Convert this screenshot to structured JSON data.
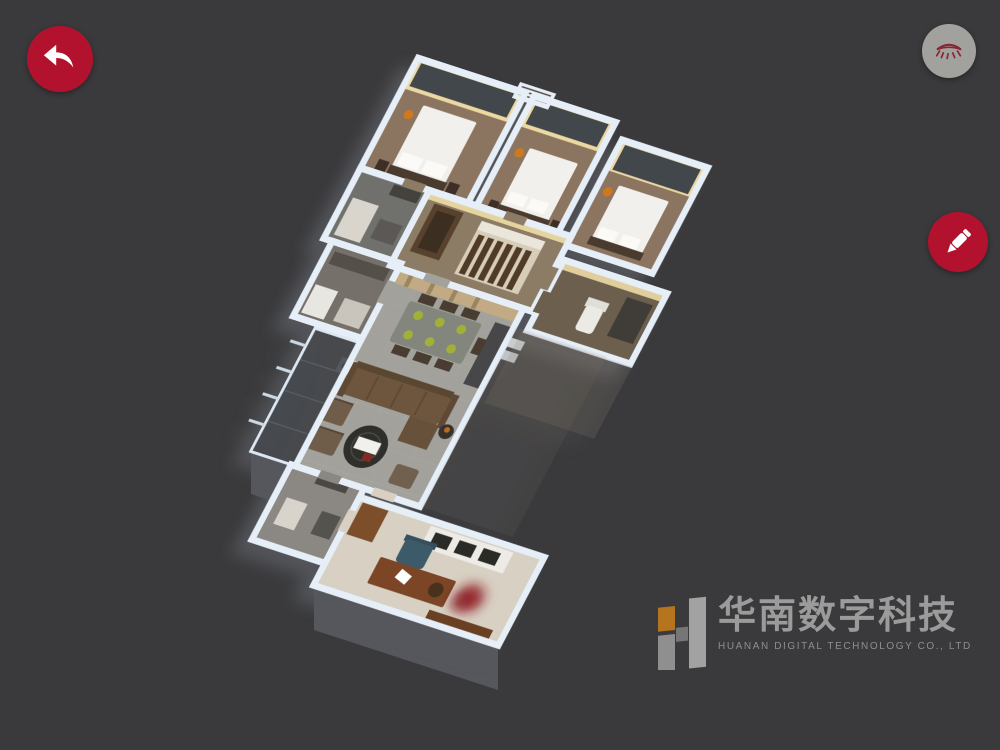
{
  "canvas": {
    "background": "#3a3a3c",
    "width": 1000,
    "height": 750
  },
  "toolbar": {
    "back_button": {
      "icon": "back-arrow-icon",
      "bg_color": "#b2122d",
      "fg_color": "#ffffff"
    },
    "visibility_button": {
      "icon": "closed-eye-icon",
      "bg_color": "#a1a19d",
      "fg_color": "#8b2433"
    },
    "pen_button": {
      "icon": "pen-icon",
      "bg_color": "#b2122d",
      "fg_color": "#ffffff"
    }
  },
  "logo": {
    "mark": "H",
    "mark_orange": "#b5741e",
    "mark_gray": "#949494",
    "title_zh": "华南数字科技",
    "subtitle_en": "HUANAN DIGITAL TECHNOLOGY CO., LTD",
    "text_color": "#9b9b9b",
    "subtitle_color": "#8e8e8e"
  },
  "scene": {
    "type": "3d-dollhouse-floorplan",
    "wall_color": "#e6eef8",
    "accent_lamp_color": "#d0781c",
    "plate_color": "#a2b038",
    "red_plant_color": "#8e141e",
    "rooms": [
      {
        "name": "bedroom-1",
        "furniture": [
          "double-bed",
          "dark-curtains",
          "bedside-lamp",
          "nightstands",
          "headboard"
        ]
      },
      {
        "name": "bedroom-2",
        "furniture": [
          "double-bed",
          "dark-curtains",
          "bedside-lamp",
          "nightstands"
        ]
      },
      {
        "name": "bedroom-3",
        "furniture": [
          "double-bed",
          "dark-curtains",
          "bedside-lamp",
          "nightstands"
        ]
      },
      {
        "name": "bathroom-1",
        "furniture": [
          "vanity-counter",
          "cabinet"
        ]
      },
      {
        "name": "hallway",
        "furniture": [
          "slatted-wardrobe",
          "door-frame",
          "ac-vent-grille"
        ]
      },
      {
        "name": "bathroom-2",
        "furniture": [
          "toilet",
          "dark-vanity"
        ]
      },
      {
        "name": "kitchen",
        "furniture": [
          "counter",
          "fridge",
          "island"
        ]
      },
      {
        "name": "living-dining-room",
        "furniture": [
          "dining-table",
          "six-green-place-settings",
          "dining-chairs",
          "sofa",
          "chaise",
          "round-coffee-table",
          "armchairs",
          "side-table",
          "stool",
          "tall-cabinet"
        ]
      },
      {
        "name": "balcony",
        "furniture": [
          "glass-railing"
        ]
      },
      {
        "name": "bathroom-3",
        "furniture": [
          "shower-fixture",
          "door"
        ]
      },
      {
        "name": "study",
        "furniture": [
          "desk",
          "office-chair",
          "bookshelf",
          "wood-cabinet",
          "red-plant"
        ]
      }
    ]
  }
}
